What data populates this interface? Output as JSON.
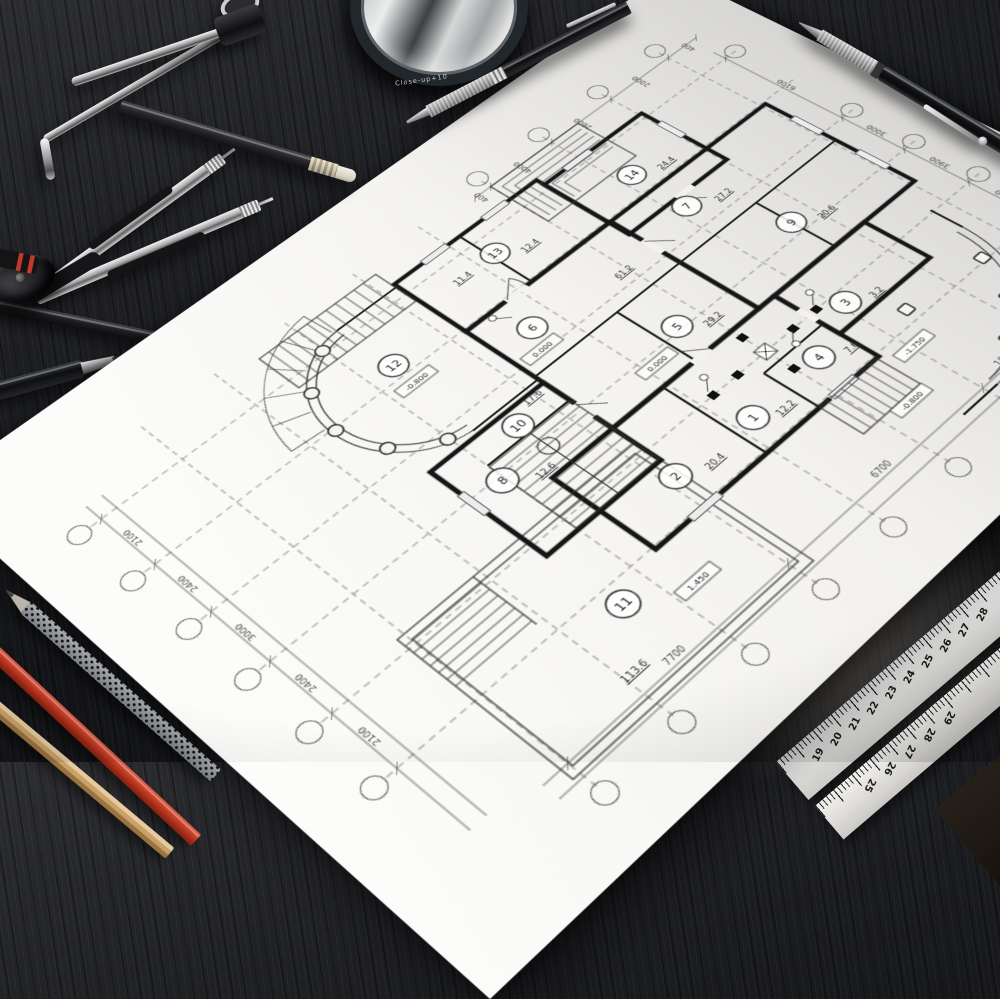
{
  "loupe": {
    "label": "Close-up+10"
  },
  "rulers": {
    "r1": [
      "19",
      "20",
      "21",
      "22",
      "23",
      "24",
      "25",
      "26",
      "27",
      "28"
    ],
    "r2": [
      "25",
      "26",
      "27",
      "28",
      "29"
    ]
  },
  "plan": {
    "rooms": [
      {
        "n": "1",
        "area": "12.2"
      },
      {
        "n": "2",
        "area": "20.4"
      },
      {
        "n": "3",
        "area": "3.2"
      },
      {
        "n": "4",
        "area": "7.6"
      },
      {
        "n": "5",
        "area": "29.2"
      },
      {
        "n": "6",
        "area": "61.2"
      },
      {
        "n": "7",
        "area": "27.2"
      },
      {
        "n": "8",
        "area": "12.6"
      },
      {
        "n": "9",
        "area": "20.6"
      },
      {
        "n": "10",
        "area": "17.6"
      },
      {
        "n": "11",
        "area": "113.6"
      },
      {
        "n": "12",
        "area": "11.4"
      },
      {
        "n": "13",
        "area": "12.4"
      },
      {
        "n": "14",
        "area": "24.4"
      }
    ],
    "elevations": [
      "0.000",
      "-0.800",
      "1.450",
      "-1.750",
      "-1.530"
    ],
    "dims_left": [
      "2100",
      "2400",
      "3000",
      "2400",
      "2100"
    ],
    "dims_bottom": [
      "7700",
      "6700",
      "1800"
    ],
    "dims_top": [
      "400",
      "4000",
      "2600",
      "2000",
      "400"
    ],
    "dims_right": [
      "6100",
      "3000",
      "3900",
      "3000"
    ]
  }
}
